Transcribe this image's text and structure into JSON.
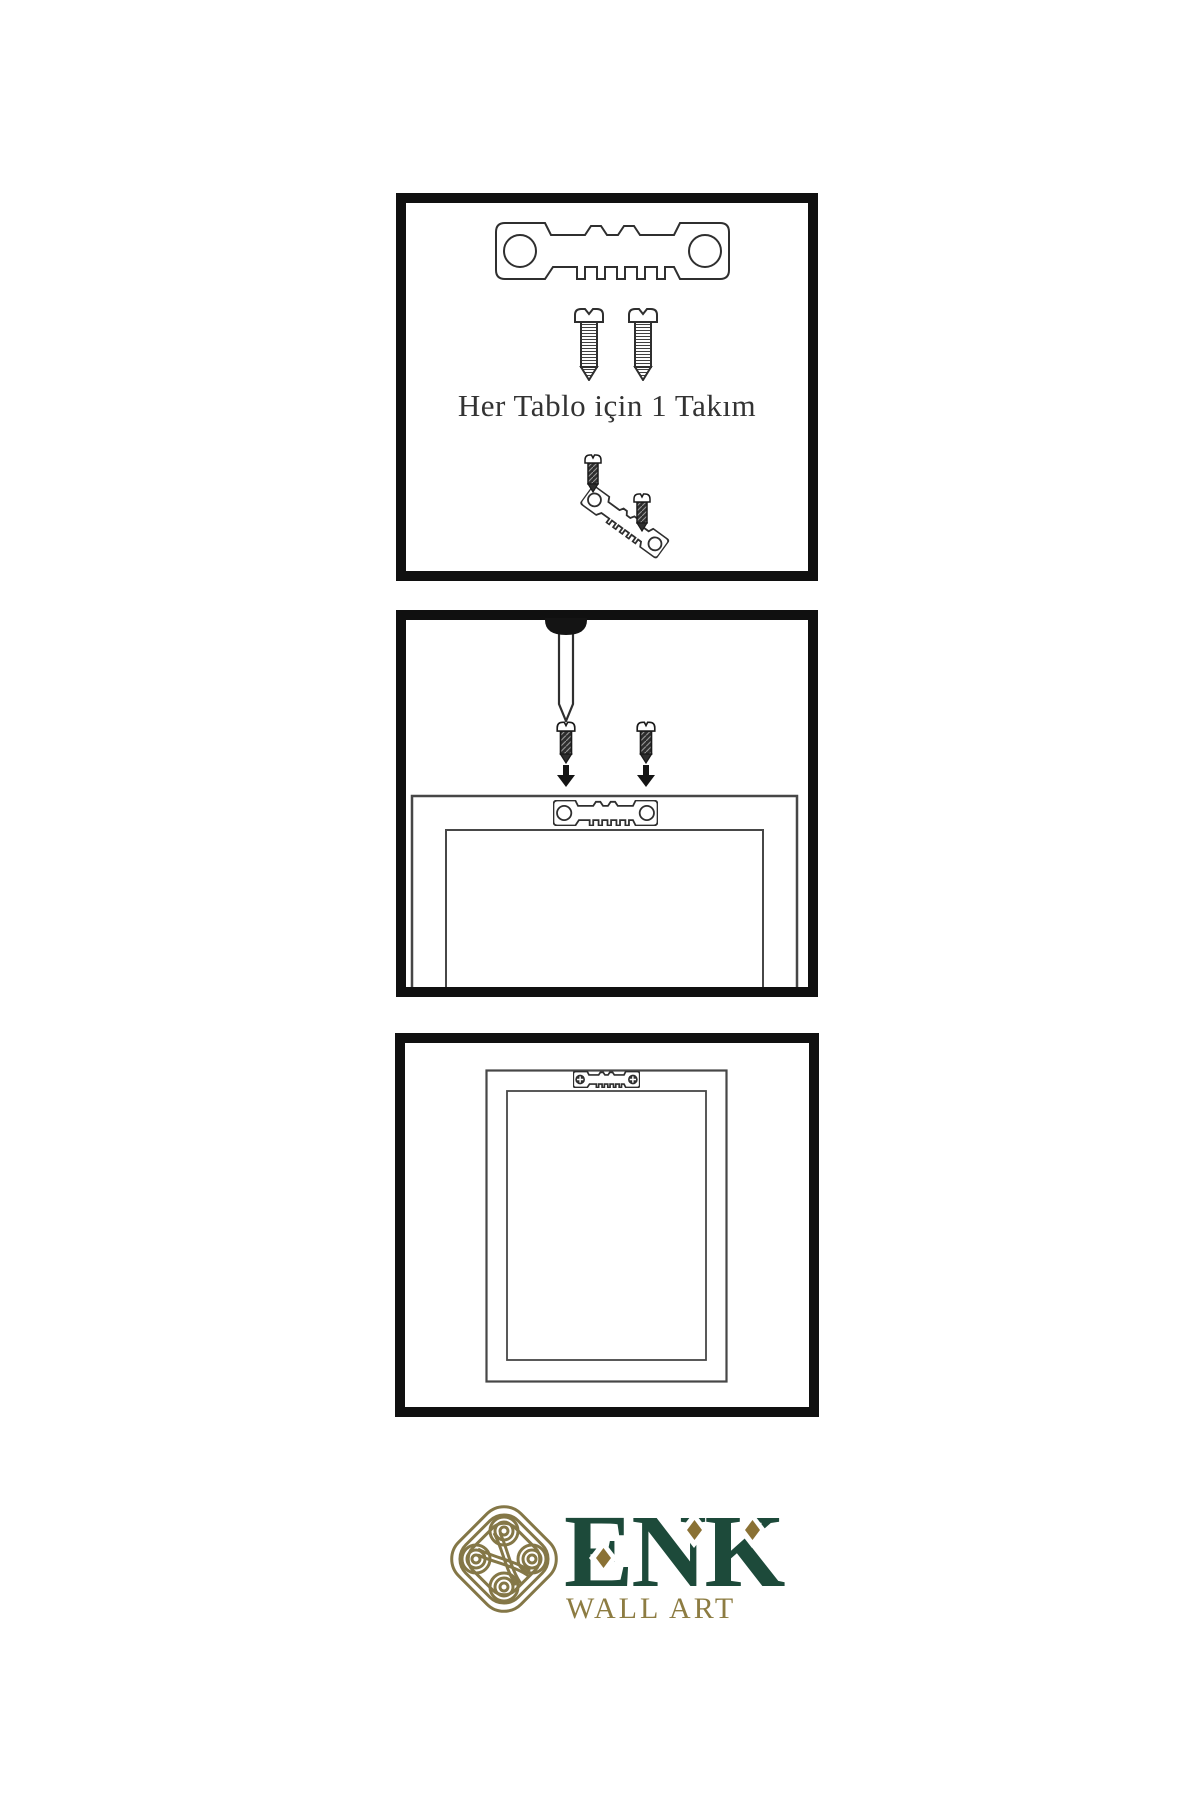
{
  "instructions": {
    "step1": {
      "caption": "Her Tablo için 1 Takım",
      "items": [
        "sawtooth-hanger",
        "screw",
        "screw",
        "mini-screw",
        "tilted-sawtooth-hanger",
        "mini-screw"
      ]
    },
    "step2": {
      "items": [
        "wall-nail",
        "screw-with-arrow",
        "screw-with-arrow",
        "frame-back",
        "sawtooth-hanger"
      ]
    },
    "step3": {
      "items": [
        "mounted-frame",
        "sawtooth-hanger-screwed"
      ]
    }
  },
  "brand": {
    "name": "ENK",
    "subtitle": "WALL ART"
  },
  "colors": {
    "background": "#ffffff",
    "panel_border": "#101010",
    "line_art": "#2f2f2f",
    "brand_green": "#1d4a3a",
    "brand_gold": "#8d7c42",
    "diamond_gold": "#8a7134",
    "knot_gold": "#847747"
  }
}
